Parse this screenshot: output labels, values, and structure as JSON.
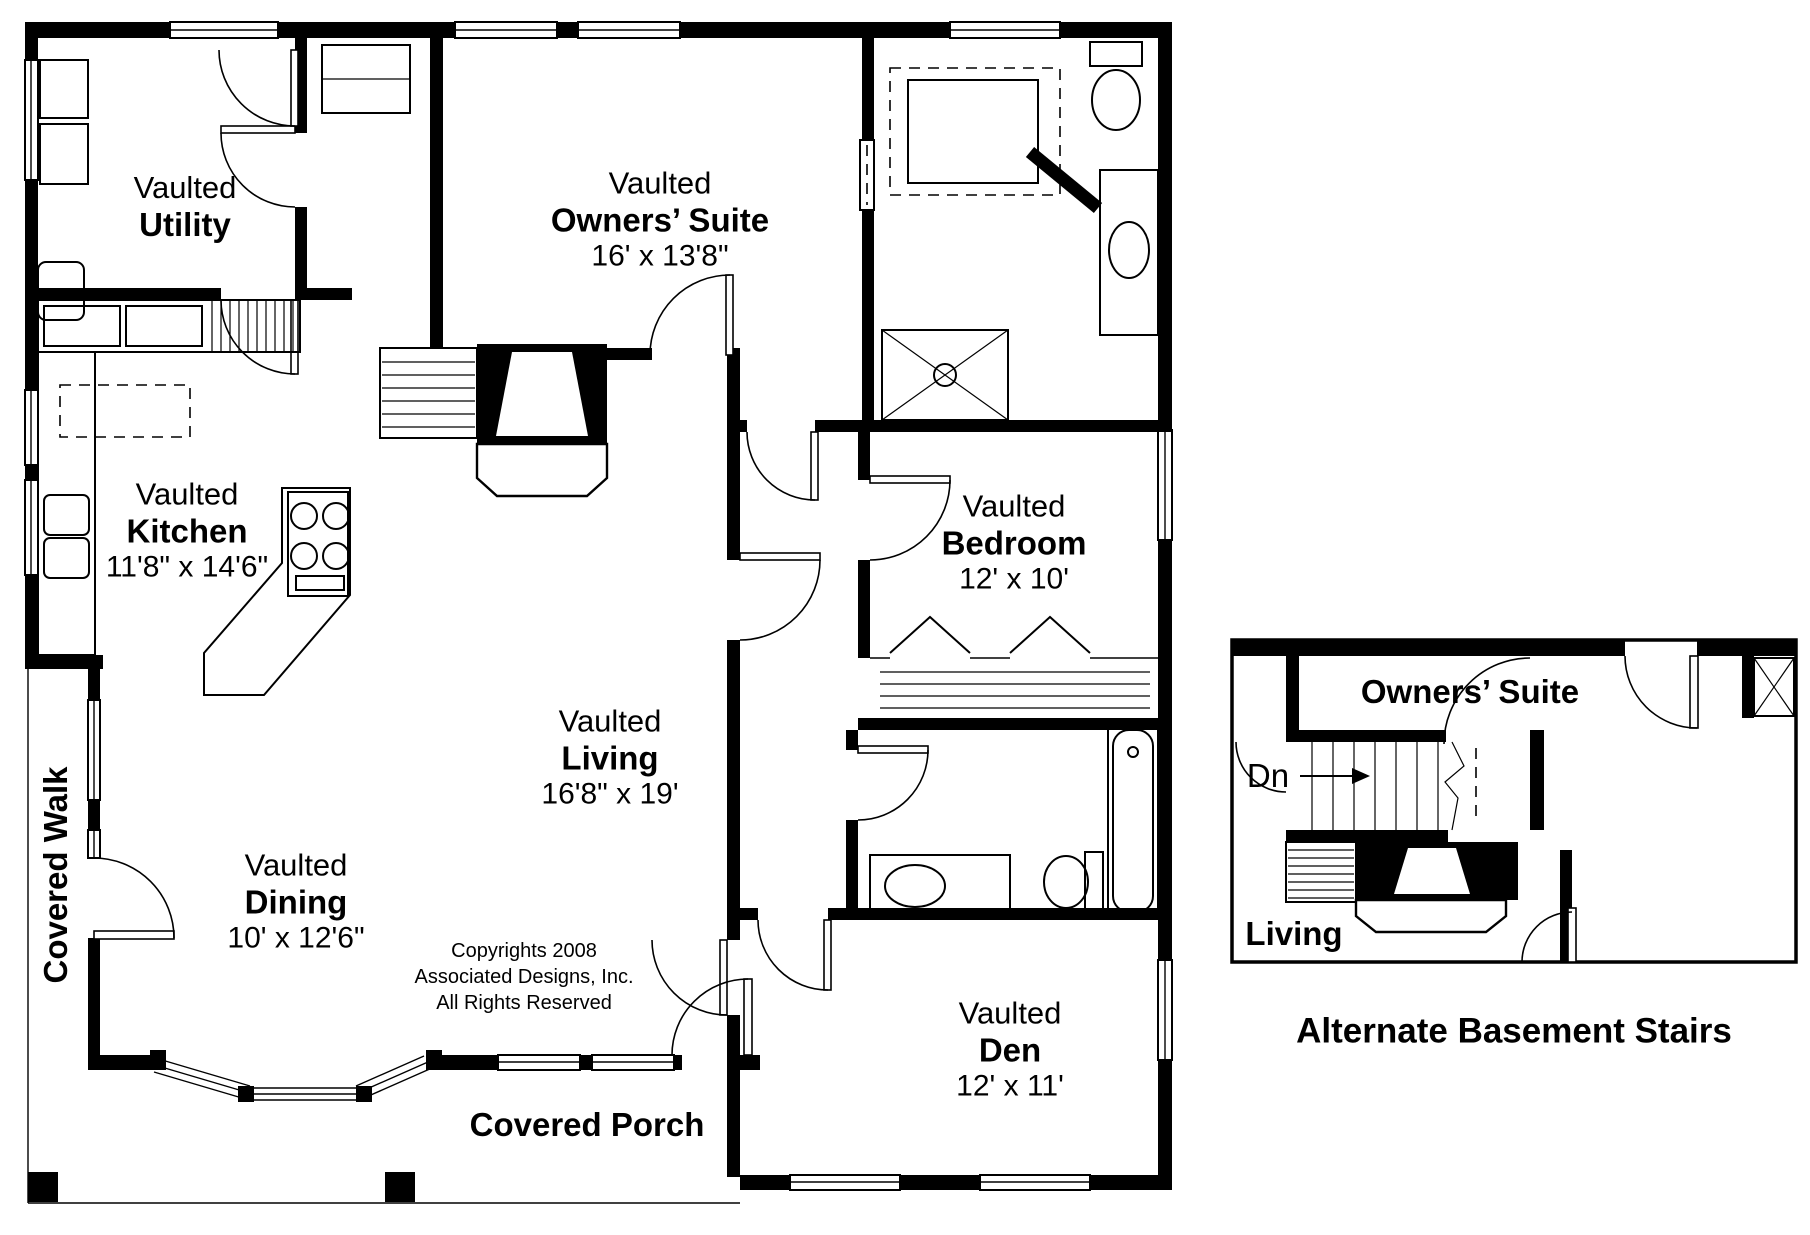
{
  "rooms": {
    "utility": {
      "prefix": "Vaulted",
      "name": "Utility"
    },
    "owners_suite": {
      "prefix": "Vaulted",
      "name": "Owners’ Suite",
      "dims": "16' x 13'8\""
    },
    "kitchen": {
      "prefix": "Vaulted",
      "name": "Kitchen",
      "dims": "11'8\" x 14'6\""
    },
    "bedroom": {
      "prefix": "Vaulted",
      "name": "Bedroom",
      "dims": "12' x 10'"
    },
    "living": {
      "prefix": "Vaulted",
      "name": "Living",
      "dims": "16'8\" x 19'"
    },
    "dining": {
      "prefix": "Vaulted",
      "name": "Dining",
      "dims": "10' x 12'6\""
    },
    "den": {
      "prefix": "Vaulted",
      "name": "Den",
      "dims": "12' x 11'"
    }
  },
  "outdoor": {
    "covered_walk": "Covered Walk",
    "covered_porch": "Covered Porch"
  },
  "copyright": {
    "line1": "Copyrights 2008",
    "line2": "Associated Designs, Inc.",
    "line3": "All Rights Reserved"
  },
  "inset": {
    "owners_suite": "Owners’ Suite",
    "down": "Dn",
    "living": "Living",
    "caption": "Alternate Basement Stairs"
  },
  "colors": {
    "line": "#000000",
    "background": "#ffffff"
  }
}
